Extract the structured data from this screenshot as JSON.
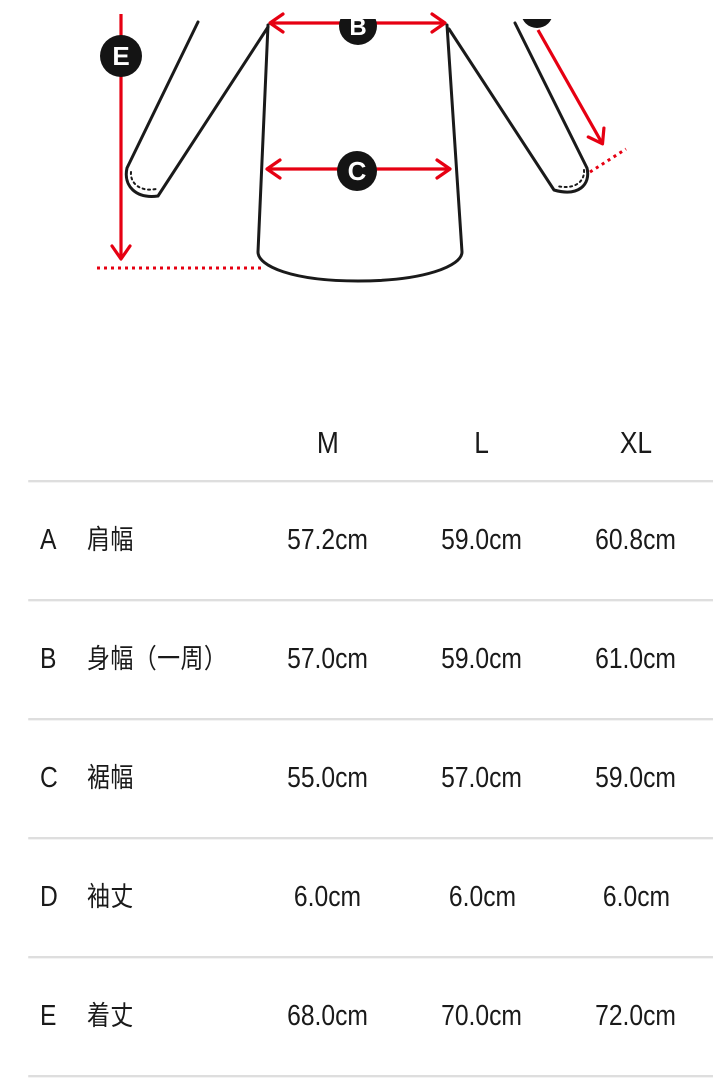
{
  "diagram": {
    "description": "garment flat sketch with measurement arrows",
    "labels": {
      "b": "B",
      "c": "C",
      "e": "E"
    },
    "colors": {
      "accent_red": "#e60012",
      "line_black": "#1a1a1a",
      "badge_black": "#141414"
    }
  },
  "size_table": {
    "columns": [
      "M",
      "L",
      "XL"
    ],
    "rows": [
      {
        "key": "A",
        "label": "肩幅",
        "values": [
          "57.2cm",
          "59.0cm",
          "60.8cm"
        ]
      },
      {
        "key": "B",
        "label": "身幅（一周）",
        "values": [
          "57.0cm",
          "59.0cm",
          "61.0cm"
        ]
      },
      {
        "key": "C",
        "label": "裾幅",
        "values": [
          "55.0cm",
          "57.0cm",
          "59.0cm"
        ]
      },
      {
        "key": "D",
        "label": "袖丈",
        "values": [
          "6.0cm",
          "6.0cm",
          "6.0cm"
        ]
      },
      {
        "key": "E",
        "label": "着丈",
        "values": [
          "68.0cm",
          "70.0cm",
          "72.0cm"
        ]
      }
    ]
  }
}
